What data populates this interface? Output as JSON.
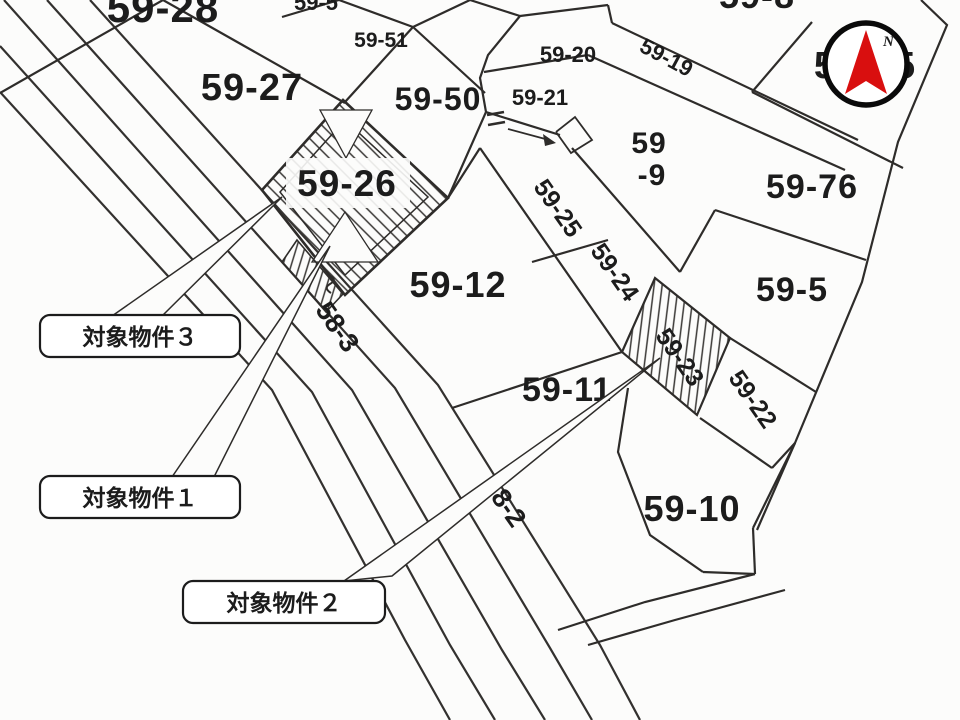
{
  "colors": {
    "line_ink": "#2e2c2a",
    "north_arrow_red": "#d90f0f",
    "paper": "#fcfcfb"
  },
  "compass": {
    "north_label": "N"
  },
  "callouts": {
    "c3": "対象物件３",
    "c1": "対象物件１",
    "c2": "対象物件２"
  },
  "parcels": {
    "p59_28": "59-28",
    "p59_5top": "59-5",
    "p59_51": "59-51",
    "p59_27": "59-27",
    "p59_50": "59-50",
    "p59_20": "59-20",
    "p59_19": "59-19",
    "p59_21": "59-21",
    "p59_8": "59-8",
    "p59_75": "59-75",
    "p59_9_line1": "59",
    "p59_9_line2": "-9",
    "p59_76": "59-76",
    "p59_26": "59-26",
    "p59_12": "59-12",
    "p59_25": "59-25",
    "p59_24": "59-24",
    "p59_5": "59-5",
    "p59_23": "59-23",
    "p59_22": "59-22",
    "p59_11": "59-11",
    "p59_10": "59-10"
  },
  "roads": {
    "r58_3": "58-3",
    "r58_2": "58-2"
  }
}
